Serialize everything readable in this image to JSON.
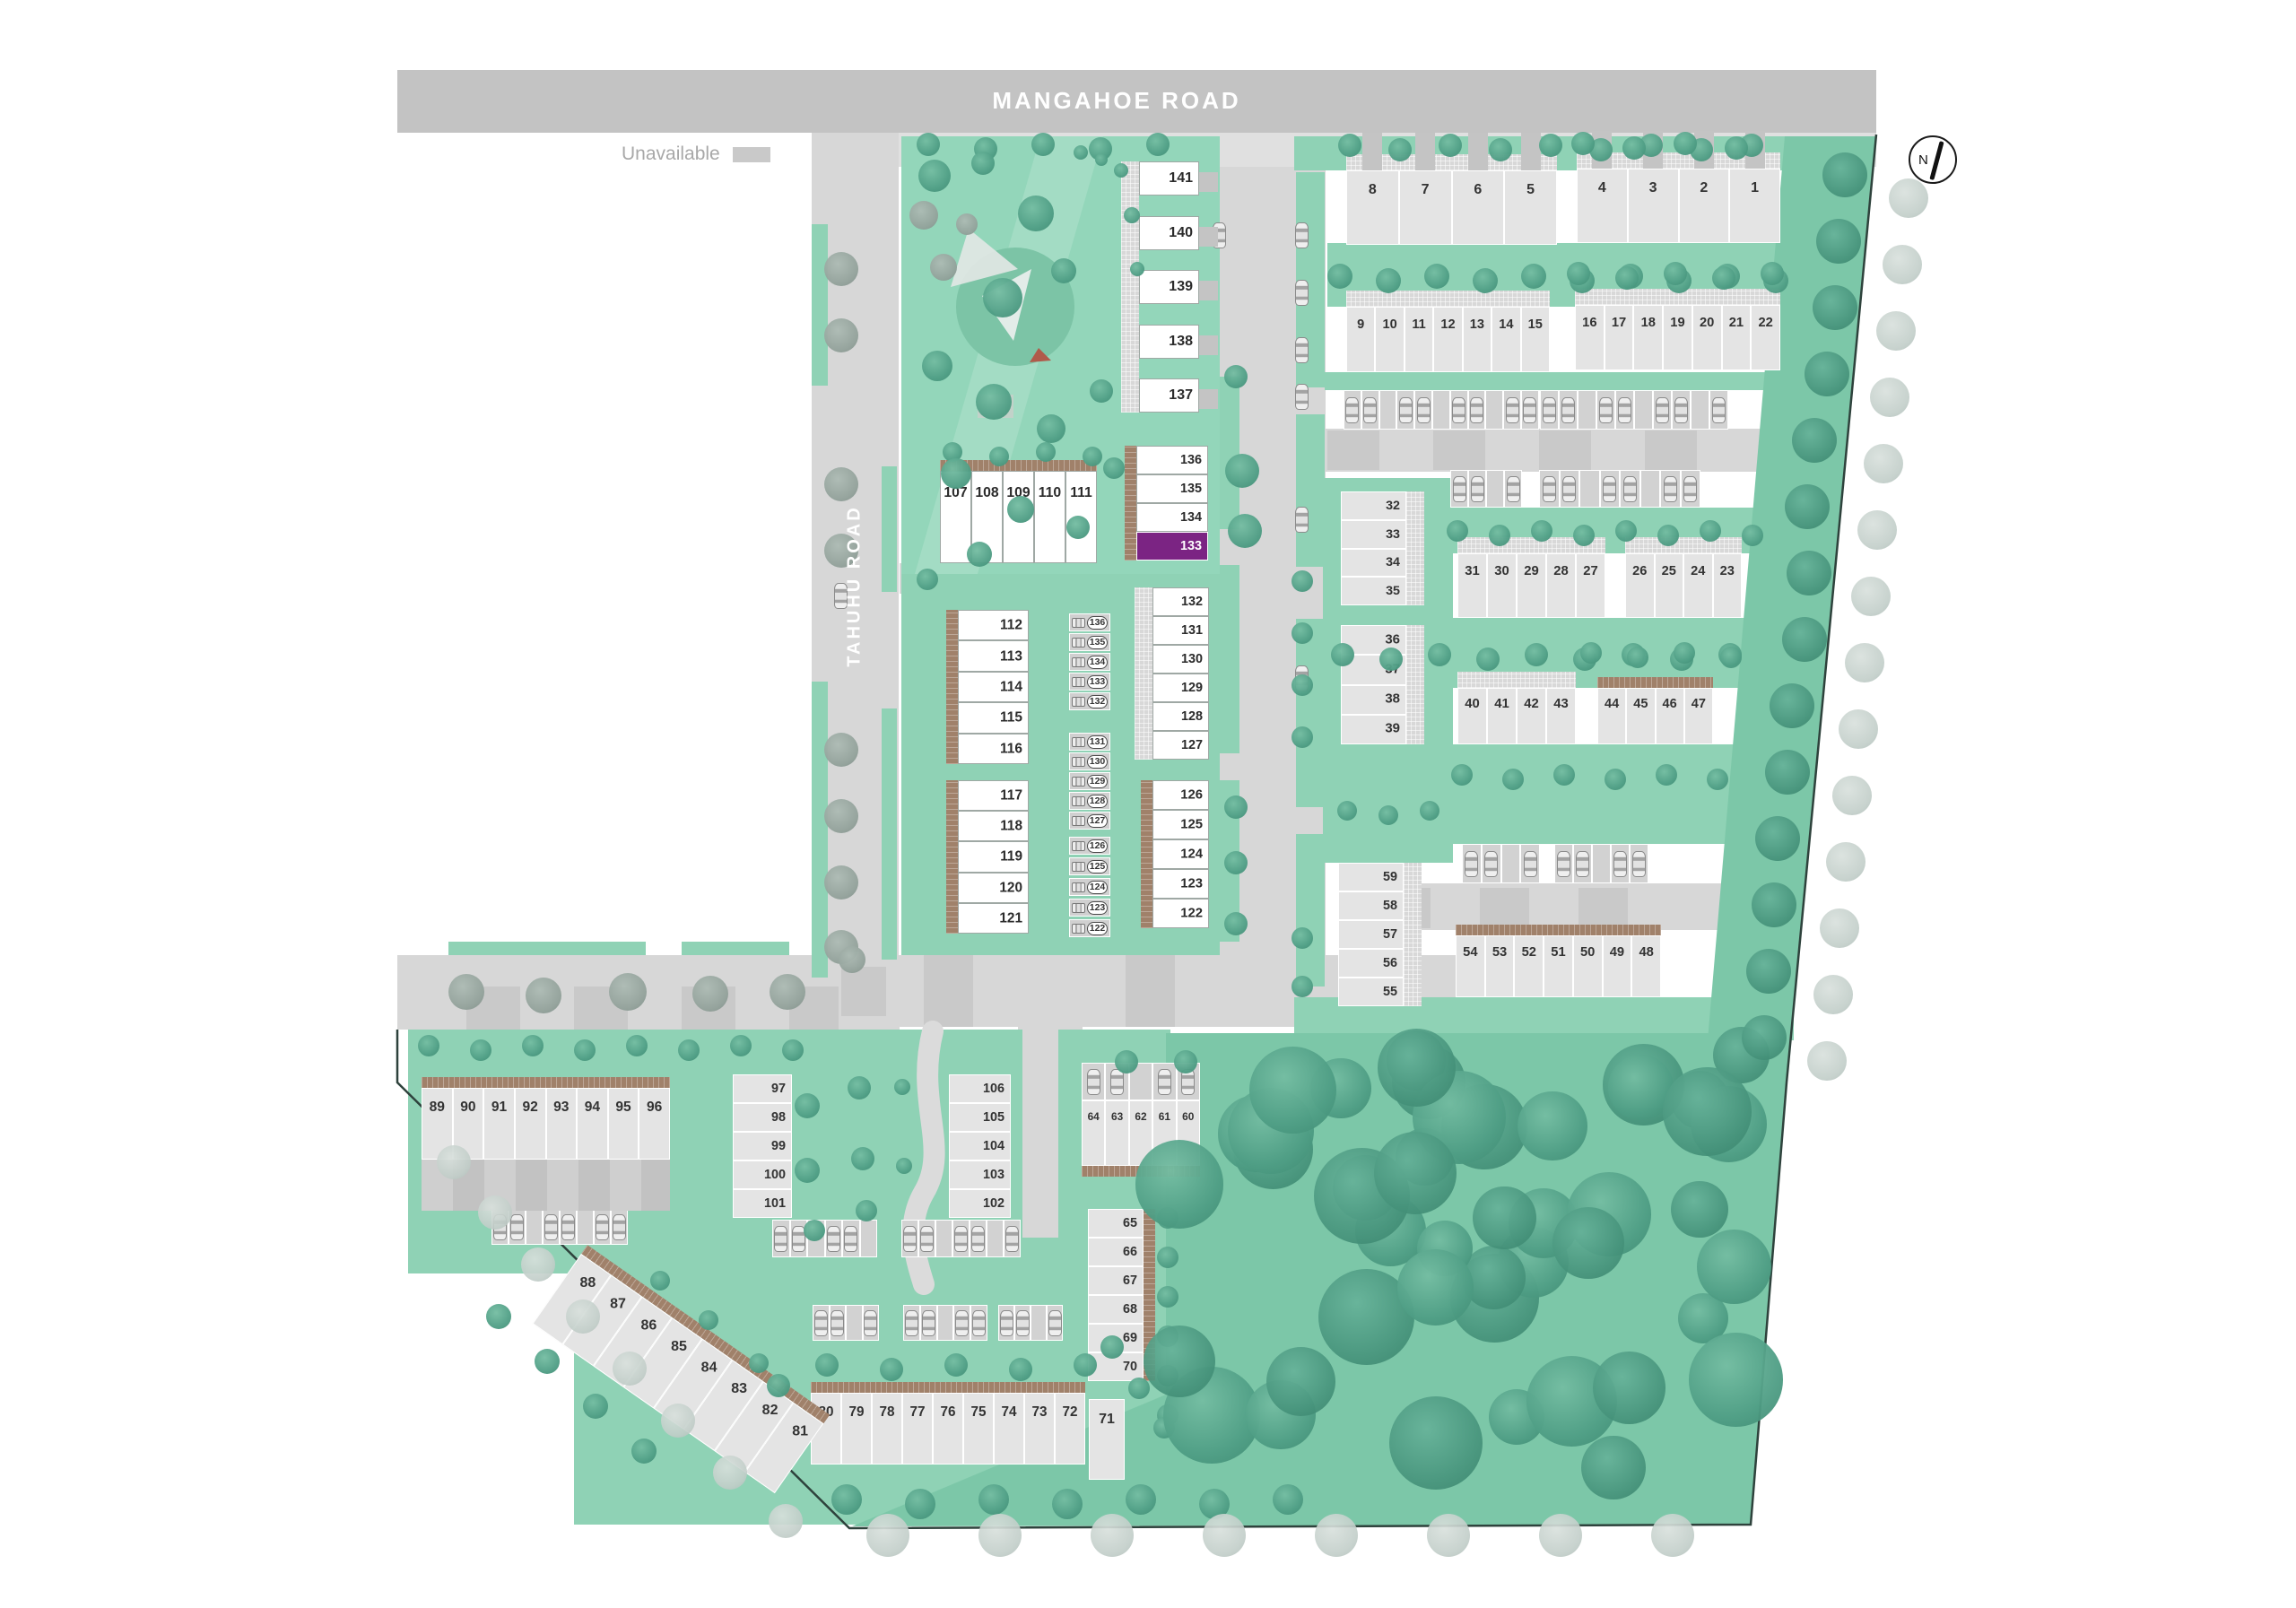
{
  "map": {
    "roads": {
      "mangahoe": "MANGAHOE ROAD",
      "tahuhu": "TAHUHU ROAD"
    },
    "legend": {
      "unavailable_label": "Unavailable"
    },
    "compass": {
      "north_label": "N"
    },
    "selected_lot": "133",
    "status_colors": {
      "available": "#FFFFFF",
      "unavailable": "#E4E4E4",
      "selected": "#7B2483"
    },
    "accent_colors": {
      "road": "#D7D7D7",
      "main_road": "#C3C3C3",
      "landscape": "#8FD2B5",
      "forest": "#7CC7A8",
      "deck": "#A0816A"
    }
  },
  "clusters": [
    {
      "id": "c1",
      "lots": [
        "8",
        "7",
        "6",
        "5"
      ],
      "status": "unavailable"
    },
    {
      "id": "c2",
      "lots": [
        "4",
        "3",
        "2",
        "1"
      ],
      "status": "unavailable"
    },
    {
      "id": "c3",
      "lots": [
        "9",
        "10",
        "11",
        "12",
        "13",
        "14",
        "15"
      ],
      "status": "unavailable"
    },
    {
      "id": "c4",
      "lots": [
        "16",
        "17",
        "18",
        "19",
        "20",
        "21",
        "22"
      ],
      "status": "unavailable"
    },
    {
      "id": "c5",
      "lots": [
        "32",
        "33",
        "34",
        "35"
      ],
      "status": "unavailable"
    },
    {
      "id": "c6",
      "lots": [
        "36",
        "37",
        "38",
        "39"
      ],
      "status": "unavailable"
    },
    {
      "id": "c7",
      "lots": [
        "31",
        "30",
        "29",
        "28",
        "27"
      ],
      "status": "unavailable"
    },
    {
      "id": "c8",
      "lots": [
        "26",
        "25",
        "24",
        "23"
      ],
      "status": "unavailable"
    },
    {
      "id": "c9",
      "lots": [
        "40",
        "41",
        "42",
        "43"
      ],
      "status": "unavailable"
    },
    {
      "id": "c10",
      "lots": [
        "44",
        "45",
        "46",
        "47"
      ],
      "status": "unavailable"
    },
    {
      "id": "c11",
      "lots": [
        "59",
        "58",
        "57",
        "56",
        "55"
      ],
      "status": "unavailable"
    },
    {
      "id": "c12",
      "lots": [
        "54",
        "53",
        "52",
        "51",
        "50",
        "49",
        "48"
      ],
      "status": "unavailable"
    },
    {
      "id": "c13",
      "lots": [
        "64",
        "63",
        "62",
        "61",
        "60"
      ],
      "status": "unavailable"
    },
    {
      "id": "c14",
      "lots": [
        "65",
        "66",
        "67",
        "68",
        "69",
        "70"
      ],
      "status": "unavailable"
    },
    {
      "id": "c15",
      "lots": [
        "80",
        "79",
        "78",
        "77",
        "76",
        "75",
        "74",
        "73",
        "72"
      ],
      "status": "unavailable"
    },
    {
      "id": "c16",
      "lots": [
        "71"
      ],
      "status": "unavailable"
    },
    {
      "id": "c17",
      "lots": [
        "88",
        "87",
        "86",
        "85",
        "84",
        "83",
        "82",
        "81"
      ],
      "status": "unavailable"
    },
    {
      "id": "c18",
      "lots": [
        "89",
        "90",
        "91",
        "92",
        "93",
        "94",
        "95",
        "96"
      ],
      "status": "unavailable"
    },
    {
      "id": "c19",
      "lots": [
        "97",
        "98",
        "99",
        "100",
        "101"
      ],
      "status": "unavailable"
    },
    {
      "id": "c20",
      "lots": [
        "106",
        "105",
        "104",
        "103",
        "102"
      ],
      "status": "unavailable"
    },
    {
      "id": "c21",
      "lots": [
        "107",
        "108",
        "109",
        "110",
        "111"
      ],
      "status": "available"
    },
    {
      "id": "c22",
      "lots": [
        "112",
        "113",
        "114",
        "115",
        "116"
      ],
      "status": "available"
    },
    {
      "id": "c23",
      "lots": [
        "117",
        "118",
        "119",
        "120",
        "121"
      ],
      "status": "available"
    },
    {
      "id": "c24",
      "lots": [
        "132",
        "131",
        "130",
        "129",
        "128",
        "127"
      ],
      "status": "available"
    },
    {
      "id": "c25",
      "lots": [
        "126",
        "125",
        "124",
        "123",
        "122"
      ],
      "status": "available"
    },
    {
      "id": "c26",
      "lots": [
        "141",
        "140",
        "139",
        "138",
        "137"
      ],
      "status": "available"
    },
    {
      "id": "c27",
      "lots": [
        "136",
        "135",
        "134",
        "133"
      ],
      "status": "available",
      "overrides": {
        "133": "selected"
      }
    }
  ],
  "parking_bays": {
    "groups": [
      [
        "136",
        "135",
        "134",
        "133",
        "132"
      ],
      [
        "131",
        "130",
        "129",
        "128",
        "127"
      ],
      [
        "126",
        "125",
        "124",
        "123",
        "122"
      ]
    ]
  }
}
